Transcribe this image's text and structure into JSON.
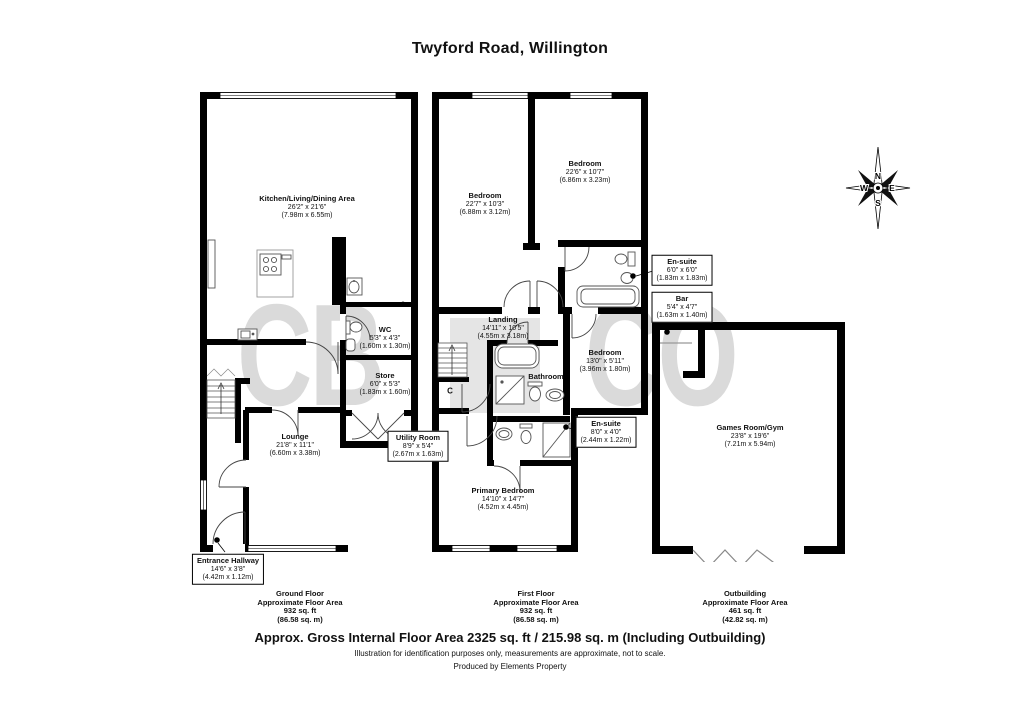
{
  "title": "Twyford Road, Willington",
  "watermark": {
    "part1": "CB",
    "part2": "CO"
  },
  "compass": {
    "north": "N",
    "east": "E",
    "south": "S",
    "west": "W"
  },
  "ground_floor": {
    "kitchen": {
      "name": "Kitchen/Living/Dining Area",
      "size_ft": "26'2\" x 21'6\"",
      "size_m": "(7.98m x 6.55m)"
    },
    "wc": {
      "name": "WC",
      "size_ft": "5'3\" x 4'3\"",
      "size_m": "(1.60m x 1.30m)"
    },
    "store": {
      "name": "Store",
      "size_ft": "6'0\" x 5'3\"",
      "size_m": "(1.83m x 1.60m)"
    },
    "utility": {
      "name": "Utility Room",
      "size_ft": "8'9\" x 5'4\"",
      "size_m": "(2.67m x 1.63m)"
    },
    "lounge": {
      "name": "Lounge",
      "size_ft": "21'8\" x 11'1\"",
      "size_m": "(6.60m x 3.38m)"
    },
    "entrance": {
      "name": "Entrance Hallway",
      "size_ft": "14'6\" x 3'8\"",
      "size_m": "(4.42m x 1.12m)"
    },
    "area": {
      "floor": "Ground Floor",
      "label": "Approximate Floor Area",
      "sqft": "932 sq. ft",
      "sqm": "(86.58 sq. m)"
    }
  },
  "first_floor": {
    "bedroom_left": {
      "name": "Bedroom",
      "size_ft": "22'7\" x 10'3\"",
      "size_m": "(6.88m x 3.12m)"
    },
    "bedroom_right": {
      "name": "Bedroom",
      "size_ft": "22'6\" x 10'7\"",
      "size_m": "(6.86m x 3.23m)"
    },
    "ensuite_top": {
      "name": "En-suite",
      "size_ft": "6'0\" x 6'0\"",
      "size_m": "(1.83m x 1.83m)"
    },
    "landing": {
      "name": "Landing",
      "size_ft": "14'11\" x 10'5\"",
      "size_m": "(4.55m x 3.18m)"
    },
    "bathroom": {
      "name": "Bathroom"
    },
    "bedroom_mid": {
      "name": "Bedroom",
      "size_ft": "13'0\" x 5'11\"",
      "size_m": "(3.96m x 1.80m)"
    },
    "ensuite_lower": {
      "name": "En-suite",
      "size_ft": "8'0\" x 4'0\"",
      "size_m": "(2.44m x 1.22m)"
    },
    "primary_bedroom": {
      "name": "Primary Bedroom",
      "size_ft": "14'10\" x 14'7\"",
      "size_m": "(4.52m x 4.45m)"
    },
    "cupboard": "C",
    "area": {
      "floor": "First Floor",
      "label": "Approximate Floor Area",
      "sqft": "932 sq. ft",
      "sqm": "(86.58 sq. m)"
    }
  },
  "outbuilding": {
    "bar": {
      "name": "Bar",
      "size_ft": "5'4\" x 4'7\"",
      "size_m": "(1.63m x 1.40m)"
    },
    "games_room": {
      "name": "Games Room/Gym",
      "size_ft": "23'8\" x 19'6\"",
      "size_m": "(7.21m x 5.94m)"
    },
    "area": {
      "floor": "Outbuilding",
      "label": "Approximate Floor Area",
      "sqft": "461 sq. ft",
      "sqm": "(42.82 sq. m)"
    }
  },
  "footer": {
    "gross_area": "Approx. Gross Internal Floor Area 2325 sq. ft / 215.98 sq. m (Including Outbuilding)",
    "disclaimer": "Illustration for identification purposes only, measurements are approximate, not to scale.",
    "produced_by": "Produced by Elements Property"
  }
}
